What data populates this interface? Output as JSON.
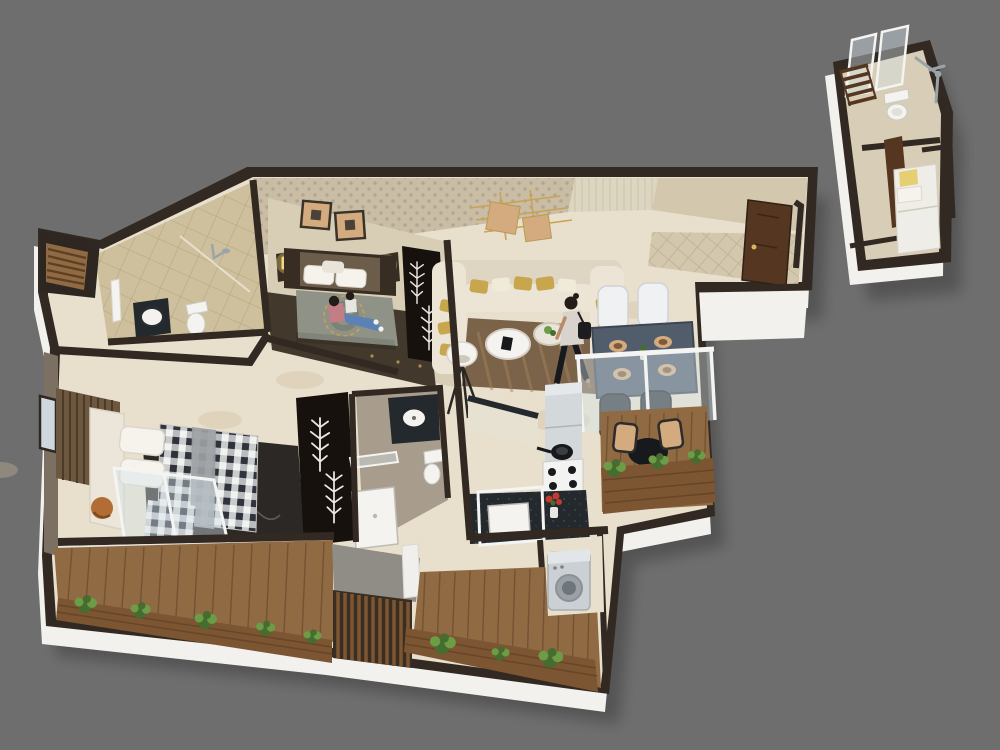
{
  "meta": {
    "kind": "3d-isometric-floor-plan-render",
    "canvas": {
      "width": 1000,
      "height": 750
    },
    "visible_text": []
  },
  "palette": {
    "bg": "#6e6e6e",
    "shadow": "rgba(0,0,0,0.24)",
    "wall": "#322a22",
    "wall_white": "#f2f1ed",
    "wall_face_light": "#e9e7e2",
    "marble": "#e8e0cd",
    "marble_blotch": "#cdbd9c",
    "tile_bath": "#cec09c",
    "tile_grout": "#ac9f7c",
    "wallpaper": "#c9bda6",
    "wallpaper_dot": "#a1947c",
    "wall_living": "#dcd5c0",
    "wall_living_stripe": "#c4bca4",
    "wall_corridor": "#d3c7ae",
    "floor_bed2": "#d8cdb5",
    "rug_bed2": "#42382c",
    "wood_dark": "#382d22",
    "headboard_pad": "#6b5d4a",
    "lamp_glow": "#f2da84",
    "wardrobe_black": "#16110d",
    "branch_white": "#e9e7e1",
    "duvet_sage": "#8e9287",
    "medallion_gold": "#caa254",
    "sofa": "#ece5d6",
    "sofa_back": "#ded5c2",
    "cushion_gold": "#c7a64e",
    "cushion_cream": "#f0ead9",
    "rug_living": "#7b6349",
    "rug_living_streak": "#a3825b",
    "table_dining": "#515d6b",
    "table_dining_edge": "#3c4652",
    "plate_rim": "#d3ab7e",
    "plate_center": "#7e5a39",
    "chair_white": "#eff1f2",
    "chair_dark": "#33373c",
    "deck": "#8f6a43",
    "deck_line": "#68492c",
    "planter": "#7c5532",
    "planter_line": "#5d3f24",
    "plant_dark": "#466d2f",
    "plant_light": "#6c9c46",
    "counter_dark": "#24292d",
    "fridge": "#d3d8db",
    "fridge_top": "#e4e8ea",
    "hob_white": "#f3f3f1",
    "pan_black": "#17191c",
    "flower_red": "#c23b31",
    "washer": "#cbd0d4",
    "washer_top": "#e2e6e9",
    "washer_door": "#9aa1a7",
    "gingham_white": "#f2f2f0",
    "gingham_mid": "#aeb3b6",
    "gingham_dark": "#30343a",
    "runner_gray": "#9b9fa2",
    "bed_frame": "#ece6da",
    "pillow_white": "#f6f3ec",
    "slat_wall": "#6d573f",
    "slat_line": "#4a3a28",
    "rug_master": "#2c2825",
    "rug_master_vein": "#6b655d",
    "pouf": "#b26d35",
    "bath2_floor": "#a89d8c",
    "nook_floor": "#8f8d86",
    "glass": "rgba(213,226,234,0.42)",
    "glass_frame": "#f4f4f2",
    "white_fixture": "#f4f3ef",
    "fixture_line": "#bcbcb4",
    "chrome": "#9aa4aa",
    "annex_floor": "#d8cdb6",
    "annex_bed": "#efede7",
    "pillow_yellow": "#e5cf72",
    "door_brown": "#553620",
    "door_frame_gold": "#d8b45c",
    "wall_taupe": "#7b7062",
    "window_glass": "#cfd8dc",
    "skin": "#b98a68",
    "hair": "#241c18",
    "jeans": "#5b82b5",
    "top_pink": "#c27d85",
    "top_white": "#d8d3cc",
    "bag_black": "#1d1d20"
  },
  "scene": {
    "units": [
      {
        "name": "main-apartment",
        "rooms": [
          "bedroom-2",
          "common-bathroom",
          "living-room",
          "dining-area",
          "entrance-foyer",
          "kitchen",
          "master-bedroom",
          "master-bathroom",
          "wardrobe-passage",
          "master-balcony",
          "rear-balcony",
          "dining-balcony",
          "utility-washer-niche",
          "duct-niche"
        ],
        "furniture": {
          "bedroom-2": [
            "double-bed",
            "two-nightstands-with-lamps",
            "two-framed-pictures",
            "branch-decor-wardrobe",
            "dark-rug"
          ],
          "common-bathroom": [
            "toilet",
            "round-washbasin",
            "shower",
            "towel-rail"
          ],
          "living-room": [
            "u-shaped-cream-sofa",
            "gold-cushions",
            "two-round-coffee-tables",
            "tripod-floor-lamp",
            "brown-rug",
            "gold-wall-art"
          ],
          "dining-area": [
            "slate-dining-table",
            "four-place-settings",
            "two-white-chairs",
            "two-dark-chairs",
            "glass-partition"
          ],
          "entrance-foyer": [
            "open-wood-entry-door",
            "herringbone-floor"
          ],
          "kitchen": [
            "fridge",
            "gas-hob-with-pan",
            "granite-counter",
            "sink",
            "red-flower-vase",
            "cabinet"
          ],
          "master-bedroom": [
            "upholstered-bed-gingham-duvet",
            "wood-slat-headboard-wall",
            "patterned-dark-rug",
            "copper-pouf",
            "sliding-glass-doors",
            "window"
          ],
          "master-bathroom": [
            "round-basin-on-counter",
            "shower-tray",
            "toilet"
          ],
          "master-balcony": [
            "wood-deck",
            "planter-with-plants"
          ],
          "rear-balcony": [
            "wood-deck",
            "planter-with-plants",
            "slat-divider"
          ],
          "dining-balcony": [
            "round-bistro-table",
            "two-wood-chairs",
            "planter-with-plants"
          ],
          "utility-washer-niche": [
            "washing-machine"
          ],
          "duct-niche": [
            "wood-louver-slats"
          ]
        },
        "people": [
          {
            "where": "bedroom-2",
            "desc": "woman-and-child-sitting-on-bed"
          },
          {
            "where": "living-room",
            "desc": "woman-walking-with-shoulder-bag"
          }
        ]
      },
      {
        "name": "detached-toilet-unit",
        "rooms": [
          "toilet-room",
          "single-bed-room"
        ],
        "furniture": {
          "toilet-room": [
            "toilet",
            "ladder-towel-rack",
            "glass-panels",
            "chrome-shower-set"
          ],
          "single-bed-room": [
            "single-bed",
            "yellow-pillow",
            "open-brown-door"
          ]
        },
        "people": []
      }
    ]
  }
}
